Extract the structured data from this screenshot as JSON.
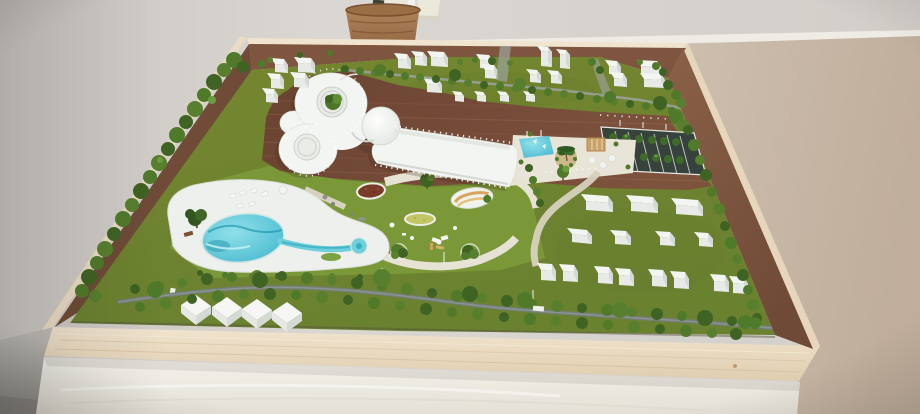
{
  "meta": {
    "description": "Photograph of an architectural scale model of a resort masterplan displayed in a plywood box on a white table against a two-tone wall with chair-rail trim",
    "scene_type": "physical architectural maquette, no on-screen text"
  },
  "scene": {
    "room": {
      "wall_left": "plain light grey-beige wall",
      "wall_right": "tan wainscot wall below white chair-rail trim",
      "trim": "white chair-rail moulding",
      "basket": "wicker basket with dark plant stem, cream frame and white easel leg behind",
      "table": "white draped display table",
      "floor": "grey floor visible at lower-left corner"
    },
    "model_box": {
      "tray": "light birch plywood tray",
      "inner_walls": "dark mahogany-stained inner walls",
      "front_face": "exposed plywood front edge"
    },
    "masterplan": {
      "main_building": "white clover-shaped resort building with two circular courtyards (one planted with a tree), a domed rotunda and a long straight wing on dark timber decking",
      "wave_pool": "turquoise kidney-shaped wave pool on white organic deck",
      "lazy_river": "narrow channel ending in a round splash pool",
      "kids_pool": "small rectangular splash pool beside a palm-tree planter and pergola plaza",
      "parking": "dark tree-lined parking lot with white bay markings",
      "park": "lawn with flowerbed, yellow planting circle, curved orange bench pavilion, picnic furniture and shrub planters",
      "hedgerows": "tree-lined canal hedgerows crossing the site and lining every edge",
      "upper_blocks_count": 23,
      "lower_slabs_count": 7,
      "lower_cube_pairs_count": 4,
      "gabled_houses_count": 4
    }
  },
  "colors": {
    "wall-1": "#c9c5c1",
    "wall-2": "#dad6d2",
    "wall-3": "#d2cec9",
    "trim": "#efece6",
    "tan-1": "#cdbeae",
    "tan-2": "#c0ae9b",
    "floor-1": "#c2bfba",
    "floor-2": "#8e8b86",
    "table-1": "#f4f2ec",
    "table-2": "#e4e0d6",
    "ply-1": "#f1e4ce",
    "ply-2": "#e0cdaf",
    "rim": "#f0e4cf",
    "inner-top": "#7e553f",
    "inner-1": "#8a6148",
    "inner-2": "#6f4a36",
    "grass-1": "#75862f",
    "grass-2": "#6a8130",
    "park": "#7c9a3a",
    "deckwood-1": "#6a4331",
    "deckwood-2": "#7d533e",
    "plank": "#875a42",
    "deck-white": "#edf0ec",
    "pool-1": "#8fe0ea",
    "pool-2": "#3fb4cb",
    "pool-dark": "#1e95aa",
    "channel": "#6fd0dc",
    "plaza": "#e9e4d8",
    "path-beige": "#d7d1bf",
    "path-white": "#e6e2d4",
    "parking": "#36423b",
    "parking-tree": "#3f6b28",
    "hedge-1": "#3f6323",
    "hedge-2": "#4f7a2a",
    "hedge-3": "#587f2e",
    "hedge-4": "#6d9b40",
    "tree-dark": "#33551f",
    "stream": "#747d78",
    "stream-up": "#99a19b",
    "road": "#9aa096",
    "flowerbed": "#7a3b29",
    "yellow-garden": "#c3c566",
    "bench-orange": "#d9a45c",
    "bench-orange-2": "#e7c078",
    "planter": "#cbb98c",
    "pergola": "#c9a267",
    "basket-1": "#b0835a",
    "basket-2": "#8a603a",
    "block-top": "#f3f5f1",
    "block-front": "#e7eae6",
    "block-side": "#d5d9d4",
    "roof-light": "#f6f7f5",
    "roof-mid": "#e5e8e4",
    "roof-dark": "#d6dad5",
    "building-white": "#f3f5f2",
    "building-edge": "#dfe2dc"
  }
}
